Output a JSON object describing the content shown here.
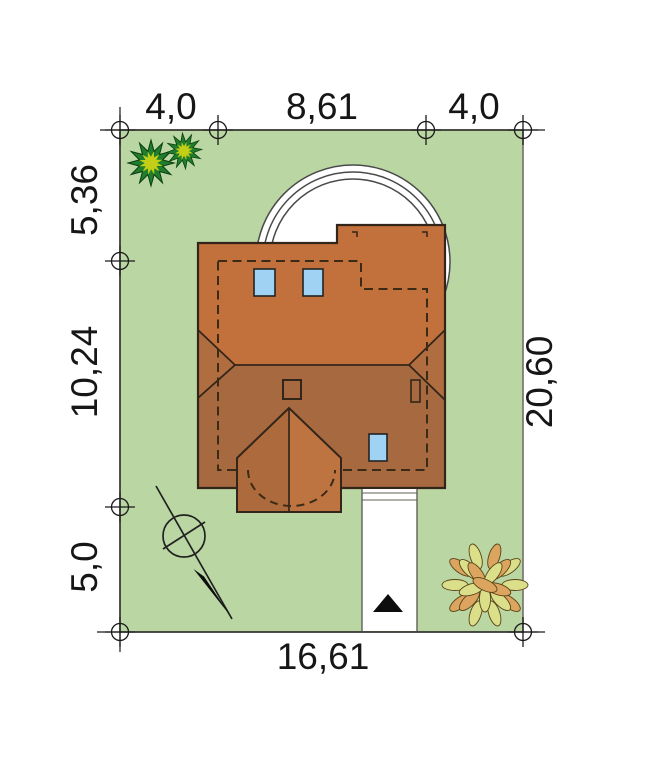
{
  "site_plan": {
    "title": "house-plot-site-plan",
    "dimensions": {
      "top": [
        "4,0",
        "8,61",
        "4,0"
      ],
      "left": [
        "5,36",
        "10,24",
        "5,0"
      ],
      "right": "20,60",
      "bottom": "16,61"
    },
    "colors": {
      "lawn": "#b9d6a3",
      "roof_north": "#c2713c",
      "roof_south": "#a7693f",
      "roof_hip": "#b06e40",
      "porch_left": "#ad6a3c",
      "porch_right": "#be7441",
      "chimney": "#b5713c",
      "skylight": "#a0d2f4",
      "driveway": "#ffffff",
      "terrace": "#ffffff",
      "bush_foliage": "#1f7d2b",
      "bush_center": "#c3cf17",
      "leaf_yellow": "#dcdf8a",
      "leaf_orange": "#dba45f",
      "ink": "#1a1a1a"
    },
    "features": {
      "north_arrow": "compass-north-arrow",
      "entrance_arrow": "driveway-entrance-arrow",
      "terrace": "semicircular-terrace-arcs",
      "shrub_top_left": "spiky-shrub-icon",
      "bush_bottom_right": "leafy-bush-icon"
    }
  }
}
